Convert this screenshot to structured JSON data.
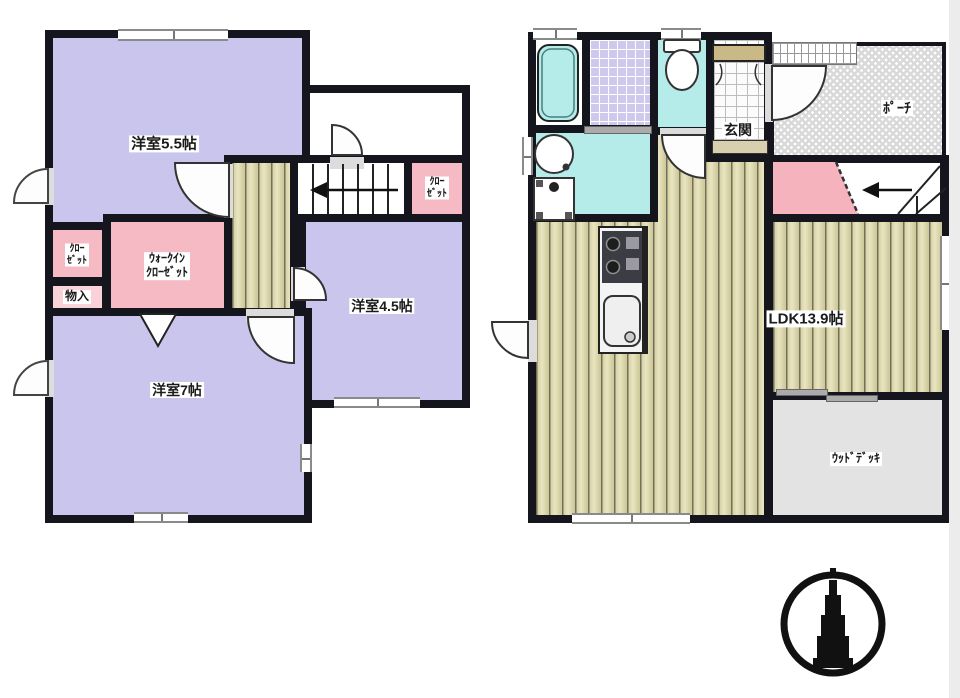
{
  "title": "間取り図",
  "floor2": {
    "bedroom55": "洋室5.5帖",
    "closet_left": "ｸﾛｰ\nｾﾞｯﾄ",
    "storage": "物入",
    "wic": "ｳｫｰｸｲﾝ\nｸﾛｰｾﾞｯﾄ",
    "closet_stairs": "ｸﾛｰ\nｾﾞｯﾄ",
    "bedroom45": "洋室4.5帖",
    "bedroom7": "洋室7帖"
  },
  "floor1": {
    "genkan": "玄関",
    "porch": "ﾎﾟｰﾁ",
    "ldk": "LDK13.9帖",
    "wood_deck": "ｳｯﾄﾞﾃﾞｯｷ"
  },
  "colors": {
    "wall": "#15151d",
    "room_purple": "#c9c5ec",
    "closet_pink": "#f5bac3",
    "floor_wood": "#d8d3a6",
    "water_cyan": "#b5ebe9",
    "tile_lavender": "#cfc9ee",
    "porch_gray": "#d9d9d9",
    "deck_gray": "#e3e3e3",
    "cabinet_tan": "#c9b987",
    "stair_pink": "#f5b3bd"
  }
}
